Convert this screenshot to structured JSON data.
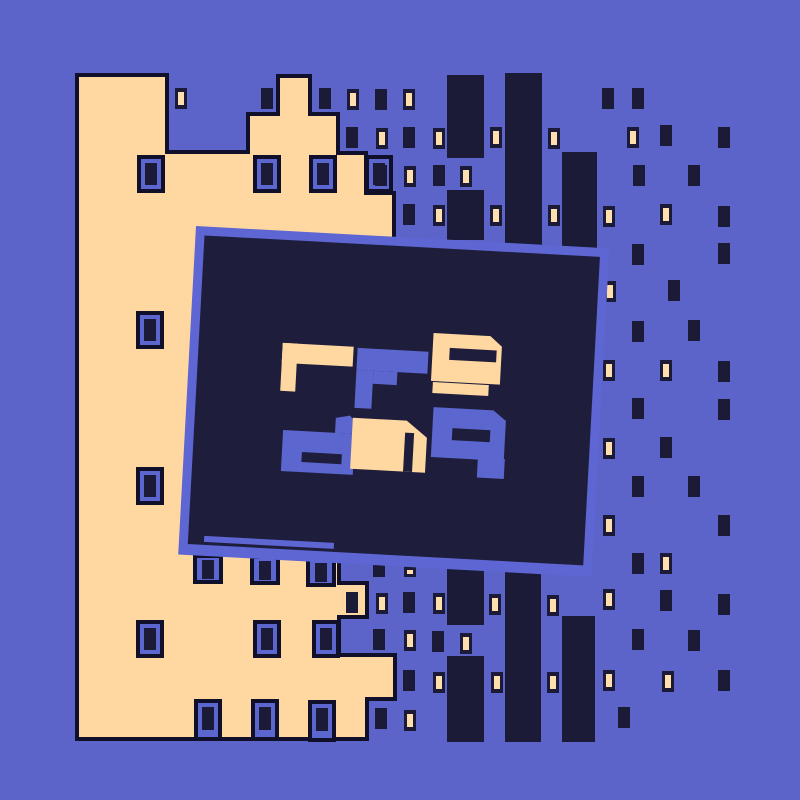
{
  "canvas": {
    "width": 800,
    "height": 800
  },
  "colors": {
    "background": "#5c64c9",
    "cream": "#ffd8a1",
    "dark": "#1b1b38",
    "outline": "#10102a",
    "panel_fill": "#1e1e3c",
    "panel_border": "#5d66d3",
    "window_blue": "#5c66cf",
    "lit_glow": "#ffdfae"
  },
  "sign": {
    "top_text": "rf9",
    "bottom_text": "dn9",
    "description": "tilted dark billboard with abstract blocky letters and a small underline stroke"
  },
  "scene": {
    "towers": [
      [
        447,
        75,
        37,
        83
      ],
      [
        447,
        190,
        37,
        50
      ],
      [
        505,
        73,
        37,
        172
      ],
      [
        562,
        152,
        35,
        100
      ],
      [
        447,
        568,
        37,
        57
      ],
      [
        447,
        656,
        37,
        86
      ],
      [
        505,
        570,
        36,
        172
      ],
      [
        562,
        616,
        33,
        126
      ]
    ],
    "building": {
      "outline_points": "77,75 167,75 167,152 248,152 248,114 278,114 278,76 310,76 310,114 338,114 338,153 366,153 366,193 394,193 394,550 339,550 339,583 367,583 367,617 339,617 339,655 395,655 395,699 367,699 367,739 77,739",
      "framed_windows": [
        [
          137,
          155
        ],
        [
          253,
          155
        ],
        [
          309,
          155
        ],
        [
          365,
          155
        ],
        [
          136,
          311
        ],
        [
          136,
          467
        ],
        [
          136,
          620
        ],
        [
          253,
          620
        ],
        [
          312,
          620
        ]
      ],
      "edge_boxes_top": [
        [
          195,
          556
        ],
        [
          252,
          557
        ],
        [
          308,
          559
        ]
      ],
      "edge_boxes_bottom": [
        [
          196,
          701
        ],
        [
          253,
          701
        ],
        [
          310,
          702
        ]
      ],
      "dark_window": [
        346,
        592
      ]
    },
    "floating_windows": [
      {
        "x": 175,
        "y": 88,
        "lit": true
      },
      {
        "x": 261,
        "y": 88,
        "lit": false
      },
      {
        "x": 319,
        "y": 88,
        "lit": false
      },
      {
        "x": 347,
        "y": 89,
        "lit": true
      },
      {
        "x": 375,
        "y": 89,
        "lit": false
      },
      {
        "x": 403,
        "y": 89,
        "lit": true
      },
      {
        "x": 602,
        "y": 88,
        "lit": false
      },
      {
        "x": 632,
        "y": 88,
        "lit": false
      },
      {
        "x": 346,
        "y": 127,
        "lit": false
      },
      {
        "x": 376,
        "y": 128,
        "lit": true
      },
      {
        "x": 403,
        "y": 127,
        "lit": false
      },
      {
        "x": 433,
        "y": 128,
        "lit": true
      },
      {
        "x": 490,
        "y": 127,
        "lit": true
      },
      {
        "x": 548,
        "y": 128,
        "lit": true
      },
      {
        "x": 627,
        "y": 127,
        "lit": true
      },
      {
        "x": 660,
        "y": 125,
        "lit": false
      },
      {
        "x": 718,
        "y": 127,
        "lit": false
      },
      {
        "x": 375,
        "y": 165,
        "lit": false
      },
      {
        "x": 404,
        "y": 166,
        "lit": true
      },
      {
        "x": 433,
        "y": 165,
        "lit": false
      },
      {
        "x": 460,
        "y": 166,
        "lit": true
      },
      {
        "x": 633,
        "y": 165,
        "lit": false
      },
      {
        "x": 688,
        "y": 165,
        "lit": false
      },
      {
        "x": 403,
        "y": 204,
        "lit": false
      },
      {
        "x": 433,
        "y": 205,
        "lit": true
      },
      {
        "x": 490,
        "y": 205,
        "lit": true
      },
      {
        "x": 548,
        "y": 205,
        "lit": true
      },
      {
        "x": 603,
        "y": 206,
        "lit": true
      },
      {
        "x": 660,
        "y": 204,
        "lit": true
      },
      {
        "x": 718,
        "y": 206,
        "lit": false
      },
      {
        "x": 632,
        "y": 244,
        "lit": false
      },
      {
        "x": 718,
        "y": 243,
        "lit": false
      },
      {
        "x": 604,
        "y": 281,
        "lit": true
      },
      {
        "x": 668,
        "y": 280,
        "lit": false
      },
      {
        "x": 632,
        "y": 321,
        "lit": false
      },
      {
        "x": 688,
        "y": 320,
        "lit": false
      },
      {
        "x": 603,
        "y": 360,
        "lit": true
      },
      {
        "x": 660,
        "y": 360,
        "lit": true
      },
      {
        "x": 718,
        "y": 361,
        "lit": false
      },
      {
        "x": 632,
        "y": 398,
        "lit": false
      },
      {
        "x": 718,
        "y": 399,
        "lit": false
      },
      {
        "x": 603,
        "y": 438,
        "lit": true
      },
      {
        "x": 660,
        "y": 437,
        "lit": false
      },
      {
        "x": 632,
        "y": 476,
        "lit": false
      },
      {
        "x": 688,
        "y": 476,
        "lit": false
      },
      {
        "x": 603,
        "y": 515,
        "lit": true
      },
      {
        "x": 718,
        "y": 515,
        "lit": false
      },
      {
        "x": 632,
        "y": 553,
        "lit": false
      },
      {
        "x": 660,
        "y": 553,
        "lit": true
      },
      {
        "x": 373,
        "y": 565,
        "w": 12,
        "h": 12,
        "lit": false
      },
      {
        "x": 404,
        "y": 566,
        "w": 12,
        "h": 11,
        "lit": true
      },
      {
        "x": 376,
        "y": 593,
        "lit": true
      },
      {
        "x": 403,
        "y": 592,
        "lit": false
      },
      {
        "x": 433,
        "y": 593,
        "lit": true
      },
      {
        "x": 489,
        "y": 594,
        "lit": true
      },
      {
        "x": 547,
        "y": 595,
        "lit": true
      },
      {
        "x": 603,
        "y": 589,
        "lit": true
      },
      {
        "x": 660,
        "y": 590,
        "lit": false
      },
      {
        "x": 718,
        "y": 594,
        "lit": false
      },
      {
        "x": 373,
        "y": 629,
        "lit": false
      },
      {
        "x": 404,
        "y": 630,
        "lit": true
      },
      {
        "x": 432,
        "y": 631,
        "lit": false
      },
      {
        "x": 460,
        "y": 633,
        "lit": true
      },
      {
        "x": 632,
        "y": 629,
        "lit": false
      },
      {
        "x": 688,
        "y": 630,
        "lit": false
      },
      {
        "x": 403,
        "y": 670,
        "lit": false
      },
      {
        "x": 433,
        "y": 672,
        "lit": true
      },
      {
        "x": 491,
        "y": 672,
        "lit": true
      },
      {
        "x": 547,
        "y": 672,
        "lit": true
      },
      {
        "x": 603,
        "y": 670,
        "lit": true
      },
      {
        "x": 662,
        "y": 671,
        "lit": true
      },
      {
        "x": 718,
        "y": 670,
        "lit": false
      },
      {
        "x": 375,
        "y": 708,
        "lit": false
      },
      {
        "x": 404,
        "y": 710,
        "lit": true
      },
      {
        "x": 618,
        "y": 707,
        "lit": false
      }
    ],
    "panel": {
      "rotation": 3.1,
      "cx": 196,
      "cy": 226,
      "outer": [
        196,
        226,
        414,
        329
      ],
      "inner": [
        205,
        235,
        396,
        309
      ],
      "underline": [
        221,
        535,
        130,
        6
      ],
      "glyphs": [
        {
          "name": "glyph-r",
          "letter": "r",
          "color": "cream",
          "shapes": [
            {
              "t": "rect",
              "v": [
                289,
                338,
                71,
                20
              ]
            },
            {
              "t": "rect",
              "v": [
                289,
                338,
                15,
                48
              ]
            }
          ],
          "slots": []
        },
        {
          "name": "glyph-f",
          "letter": "f",
          "color": "blue",
          "shapes": [
            {
              "t": "rect",
              "v": [
                364,
                339,
                71,
                22
              ]
            },
            {
              "t": "rect",
              "v": [
                364,
                361,
                17,
                38
              ]
            },
            {
              "t": "rect",
              "v": [
                381,
                361,
                24,
                13
              ]
            }
          ],
          "slots": []
        },
        {
          "name": "glyph-9-top",
          "letter": "9",
          "color": "cream",
          "shapes": [
            {
              "t": "poly",
              "v": "439,320 496,320 508,330 508,368 439,368"
            },
            {
              "t": "rect",
              "v": [
                441,
                369,
                56,
                11
              ]
            }
          ],
          "slots": [
            [
              456,
              334,
              47,
              12
            ]
          ]
        },
        {
          "name": "glyph-d",
          "letter": "d",
          "color": "blue",
          "shapes": [
            {
              "t": "rect",
              "v": [
                294,
                425,
                72,
                41
              ]
            },
            {
              "t": "poly",
              "v": "346,425 346,410 360,407 366,413 366,425"
            }
          ],
          "slots": [
            [
              314,
              446,
              40,
              10
            ]
          ]
        },
        {
          "name": "glyph-n",
          "letter": "n",
          "color": "cream",
          "shapes": [
            {
              "t": "poly",
              "v": "363,409 417,409 438,425 438,460 363,460"
            }
          ],
          "slots": [
            [
              416,
              421,
              9,
              39
            ]
          ]
        },
        {
          "name": "glyph-9-bottom",
          "letter": "9",
          "color": "blue",
          "shapes": [
            {
              "t": "poly",
              "v": "443,394 503,394 516,404 516,444 443,444"
            },
            {
              "t": "rect",
              "v": [
                490,
                442,
                27,
                20
              ]
            }
          ],
          "slots": [
            [
              463,
              414,
              38,
              12
            ]
          ]
        }
      ]
    }
  }
}
